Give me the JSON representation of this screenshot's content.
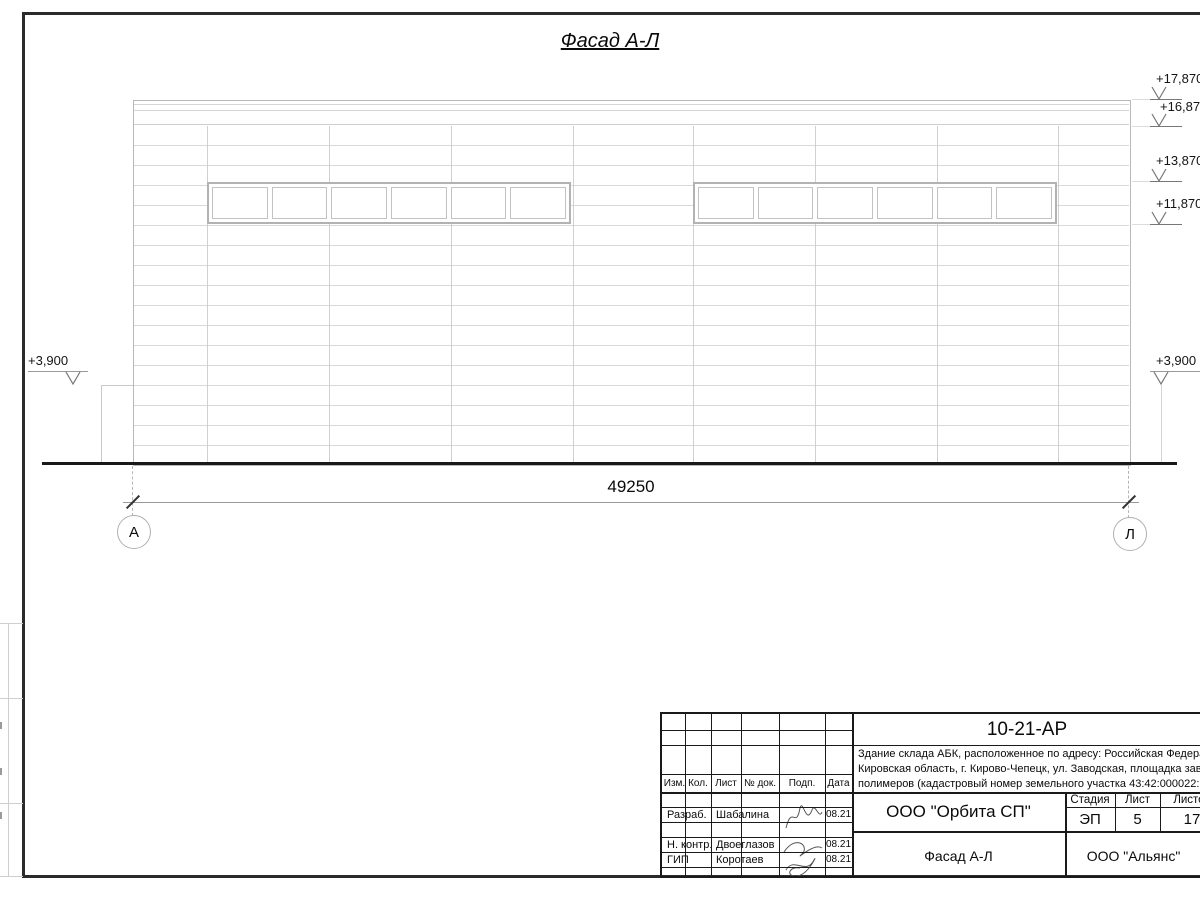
{
  "sheet": {
    "view_title": "Фасад А-Л",
    "dimension_total": "49250",
    "axes": {
      "left": "А",
      "right": "Л"
    },
    "elevations": {
      "left": "+3,900",
      "right_lower": "+3,900",
      "right_upper": [
        "+17,870",
        "+16,870",
        "+13,870",
        "+11,870"
      ]
    }
  },
  "title_block": {
    "doc_number": "10-21-АР",
    "description": [
      "Здание склада АБК, расположенное по адресу: Российская Федерац",
      "Кировская область, г. Кирово-Чепецк, ул. Заводская, площадка заво",
      "полимеров (кадастровый номер земельного участка 43:42:000022:"
    ],
    "rev_header": {
      "izm": "Изм.",
      "kol": "Кол.",
      "list": "Лист",
      "doc": "№ док.",
      "podp": "Подп.",
      "data": "Дата"
    },
    "signature_rows": [
      {
        "role": "Разраб.",
        "name": "Шабалина",
        "date": "08.21"
      },
      {
        "role": "Н. контр.",
        "name": "Двоеглазов",
        "date": "08.21"
      },
      {
        "role": "ГИП",
        "name": "Коротаев",
        "date": "08.21"
      }
    ],
    "design_company": "ООО \"Орбита СП\"",
    "stage": {
      "label": "Стадия",
      "value": "ЭП"
    },
    "sheet_no": {
      "label": "Лист",
      "value": "5"
    },
    "sheets_total": {
      "label": "Листов",
      "value": "17"
    },
    "view_name": "Фасад А-Л",
    "client_company": "ООО \"Альянс\""
  },
  "colors": {
    "facade_line": "#d9d9d9",
    "window_frame": "#b2b2b2",
    "ground_line": "#181818",
    "frame_line": "#2b2b2b"
  }
}
